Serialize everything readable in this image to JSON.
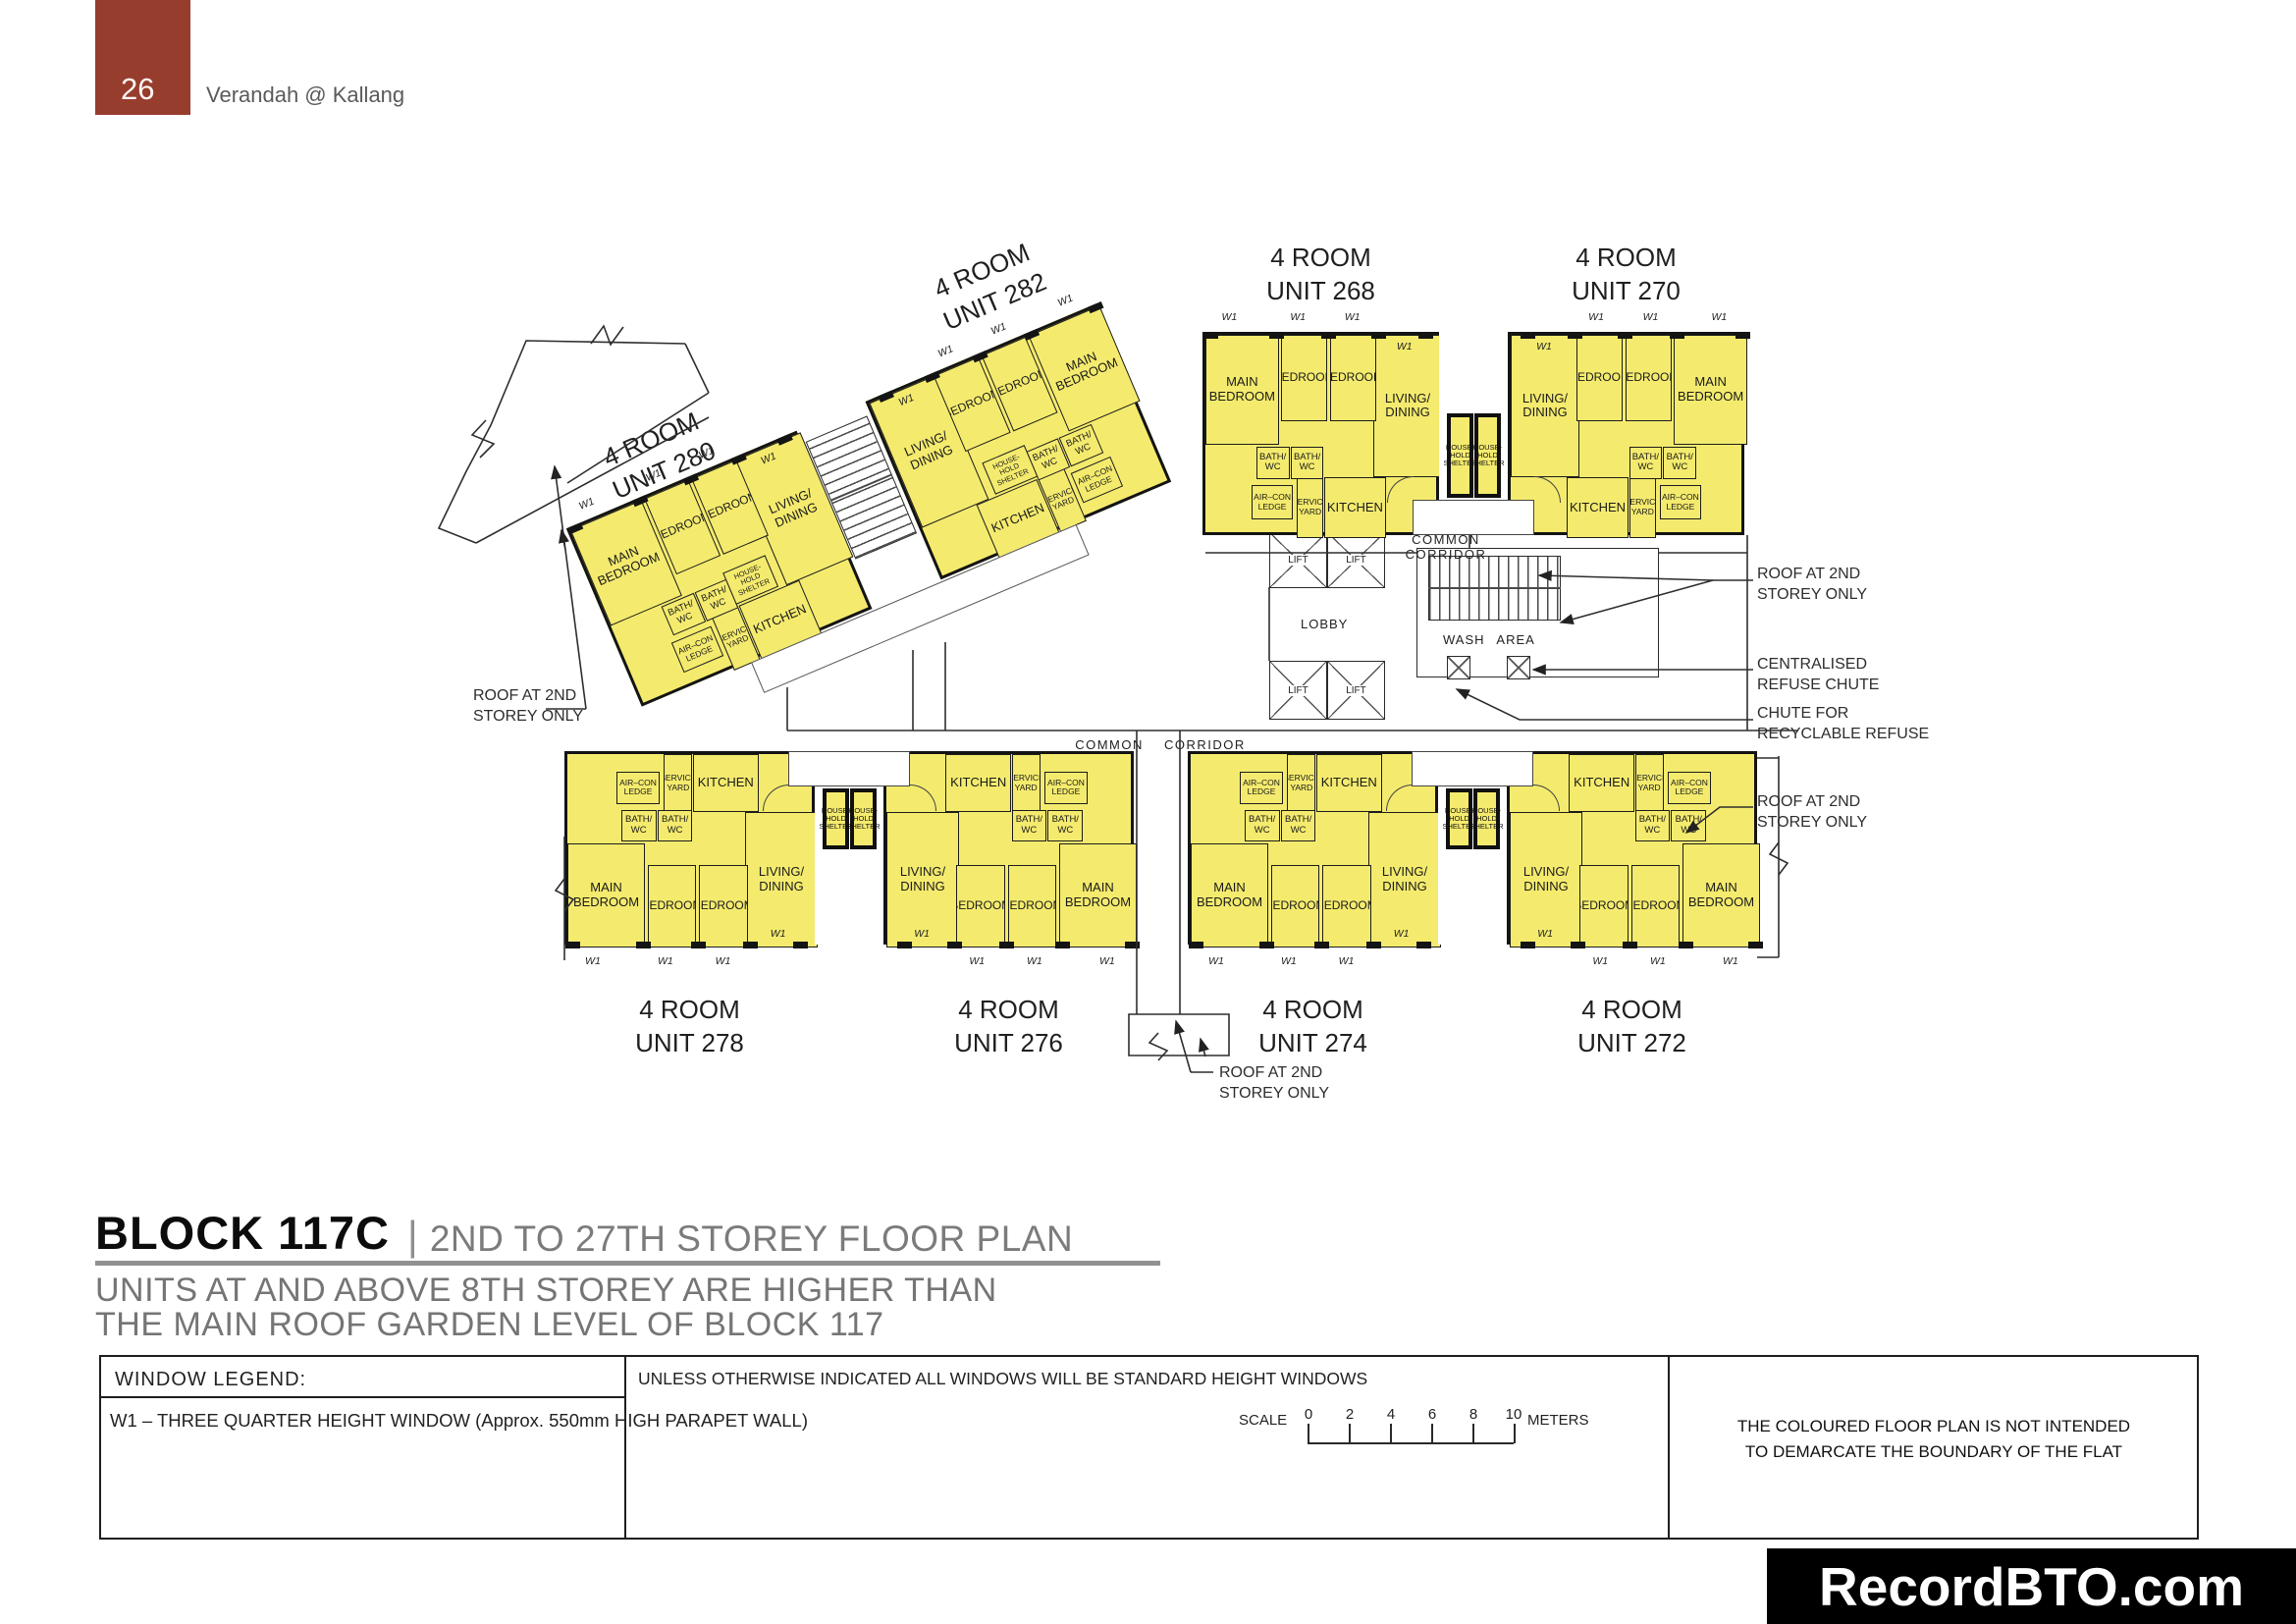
{
  "page": {
    "number": "26",
    "project_name": "Verandah @ Kallang"
  },
  "title": {
    "block": "BLOCK 117C",
    "divider": "|",
    "subtitle": "2ND TO 27TH STOREY FLOOR PLAN",
    "note": "UNITS AT AND ABOVE 8TH STOREY ARE HIGHER THAN\nTHE MAIN ROOF GARDEN LEVEL OF BLOCK 117"
  },
  "plan": {
    "units": [
      {
        "type": "4 ROOM",
        "unit": "UNIT 282"
      },
      {
        "type": "4 ROOM",
        "unit": "UNIT 280"
      },
      {
        "type": "4 ROOM",
        "unit": "UNIT 268"
      },
      {
        "type": "4 ROOM",
        "unit": "UNIT 270"
      },
      {
        "type": "4 ROOM",
        "unit": "UNIT 278"
      },
      {
        "type": "4 ROOM",
        "unit": "UNIT 276"
      },
      {
        "type": "4 ROOM",
        "unit": "UNIT 274"
      },
      {
        "type": "4 ROOM",
        "unit": "UNIT 272"
      }
    ],
    "rooms": {
      "main_bedroom": "MAIN\nBEDROOM",
      "bedroom": "BEDROOM",
      "living_dining": "LIVING/\nDINING",
      "bath_wc": "BATH/\nWC",
      "kitchen": "KITCHEN",
      "service_yard": "SERVICE\nYARD",
      "aircon_ledge": "AIR–CON\nLEDGE",
      "household_shelter": "HOUSE-\nHOLD\nSHELTER",
      "window_tag": "W1"
    },
    "labels": {
      "common_corridor": "COMMON CORRIDOR",
      "lobby": "LOBBY",
      "lift": "LIFT",
      "wash_area": "WASH AREA"
    },
    "annotations": {
      "roof_2nd_storey": "ROOF AT 2ND\nSTOREY ONLY",
      "centralised_refuse_chute": "CENTRALISED\nREFUSE CHUTE",
      "recyclable_refuse_chute": "CHUTE FOR\nRECYCLABLE REFUSE"
    }
  },
  "legend": {
    "heading": "WINDOW LEGEND:",
    "w1_item": "W1  –  THREE QUARTER HEIGHT WINDOW (Approx. 550mm HIGH PARAPET WALL)",
    "windows_note": "UNLESS OTHERWISE INDICATED ALL WINDOWS WILL BE STANDARD HEIGHT WINDOWS"
  },
  "scalebar": {
    "label": "SCALE",
    "ticks": [
      "0",
      "2",
      "4",
      "6",
      "8",
      "10"
    ],
    "unit": "METERS"
  },
  "disclaimer": "THE COLOURED FLOOR PLAN IS NOT INTENDED\nTO DEMARCATE THE BOUNDARY OF THE FLAT",
  "watermark": "RecordBTO.com",
  "colors": {
    "unit_fill": "#F4EB6E",
    "wall": "#1b1b1b",
    "header_box": "#963D2E",
    "title_gray": "#7B7B7B"
  }
}
